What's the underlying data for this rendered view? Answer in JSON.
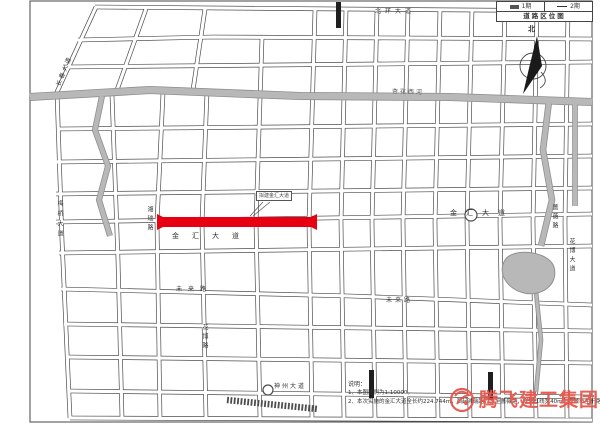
{
  "legend": {
    "title": "道路区位图",
    "items": [
      {
        "symbol": "bar",
        "label": "1期"
      },
      {
        "symbol": "line",
        "label": "2期"
      }
    ]
  },
  "north_label": "北",
  "callout": {
    "text": "拟建金汇大道"
  },
  "notes": {
    "heading": "说明：",
    "items": [
      "1、本图比例为1:10000。",
      "2、本次实施的金汇大道全长约224.744m，西起湘瑞路，东至蔷薇路，规划红线宽40m，为城市主干路。"
    ]
  },
  "logo": {
    "text": "腾飞建工集团"
  },
  "colors": {
    "red": "#e60012",
    "casing": "#4d4d4d",
    "road_fill": "#ffffff",
    "river": "#b8b8b8",
    "river_edge": "#8f8f8f",
    "ink": "#333333",
    "logo_red": "#e4574d",
    "black_seg": "#1f1f1f",
    "border": "#444444"
  },
  "map": {
    "border": {
      "x": 30,
      "y": 1,
      "w": 562,
      "h": 421
    },
    "streets": [
      [
        [
          95,
          7
        ],
        [
          592,
          11
        ]
      ],
      [
        [
          96,
          7
        ],
        [
          57,
          92
        ],
        [
          62,
          240
        ],
        [
          70,
          418
        ]
      ],
      [
        [
          146,
          9
        ],
        [
          117,
          90
        ]
      ],
      [
        [
          205,
          9
        ],
        [
          193,
          90
        ]
      ],
      [
        [
          78,
          40
        ],
        [
          213,
          37
        ],
        [
          592,
          39
        ]
      ],
      [
        [
          63,
          67
        ],
        [
          592,
          62
        ]
      ],
      [
        [
          58,
          129
        ],
        [
          592,
          124
        ]
      ],
      [
        [
          57,
          162
        ],
        [
          592,
          156
        ]
      ],
      [
        [
          56,
          194
        ],
        [
          592,
          188
        ]
      ],
      [
        [
          56,
          222
        ],
        [
          592,
          214
        ]
      ],
      [
        [
          59,
          253
        ],
        [
          592,
          246
        ]
      ],
      [
        [
          61,
          289
        ],
        [
          350,
          296
        ],
        [
          592,
          305
        ]
      ],
      [
        [
          64,
          324
        ],
        [
          592,
          331
        ]
      ],
      [
        [
          66,
          357
        ],
        [
          592,
          363
        ]
      ],
      [
        [
          68,
          391
        ],
        [
          592,
          397
        ]
      ],
      [
        [
          70,
          418
        ],
        [
          592,
          420
        ]
      ],
      [
        [
          112,
          95
        ],
        [
          118,
          260
        ],
        [
          122,
          418
        ]
      ],
      [
        [
          163,
          93
        ],
        [
          157,
          222
        ],
        [
          160,
          418
        ]
      ],
      [
        [
          207,
          92
        ],
        [
          202,
          222
        ],
        [
          206,
          418
        ]
      ],
      [
        [
          262,
          38
        ],
        [
          256,
          222
        ],
        [
          260,
          418
        ]
      ],
      [
        [
          315,
          10
        ],
        [
          309,
          222
        ],
        [
          312,
          418
        ]
      ],
      [
        [
          346,
          10
        ],
        [
          341,
          222
        ],
        [
          344,
          418
        ]
      ],
      [
        [
          377,
          9
        ],
        [
          372,
          222
        ],
        [
          375,
          418
        ]
      ],
      [
        [
          408,
          9
        ],
        [
          403,
          222
        ],
        [
          406,
          418
        ]
      ],
      [
        [
          440,
          9
        ],
        [
          435,
          222
        ],
        [
          438,
          418
        ]
      ],
      [
        [
          472,
          9
        ],
        [
          467,
          222
        ],
        [
          470,
          418
        ]
      ],
      [
        [
          505,
          9
        ],
        [
          500,
          222
        ],
        [
          503,
          418
        ]
      ],
      [
        [
          537,
          9
        ],
        [
          533,
          222
        ],
        [
          536,
          418
        ]
      ],
      [
        [
          568,
          9
        ],
        [
          565,
          222
        ],
        [
          567,
          418
        ]
      ]
    ],
    "rivers": [
      {
        "pts": [
          [
            30,
            97
          ],
          [
            150,
            90
          ],
          [
            300,
            96
          ],
          [
            450,
            97
          ],
          [
            592,
            102
          ]
        ],
        "w": 6.5
      },
      {
        "pts": [
          [
            102,
            96
          ],
          [
            95,
            130
          ],
          [
            108,
            166
          ],
          [
            99,
            200
          ],
          [
            110,
            236
          ]
        ],
        "w": 4.5
      },
      {
        "pts": [
          [
            549,
            101
          ],
          [
            543,
            150
          ],
          [
            552,
            200
          ],
          [
            541,
            246
          ]
        ],
        "w": 5
      },
      {
        "pts": [
          [
            536,
            292
          ],
          [
            541,
            340
          ],
          [
            536,
            392
          ]
        ],
        "w": 3
      },
      {
        "pts": [
          [
            575,
            102
          ],
          [
            575,
            206
          ]
        ],
        "w": 4
      }
    ],
    "lake_path": "M505,260 C513,247 549,251 554,267 C559,285 541,297 524,293 C507,289 497,273 505,260 Z",
    "black_segments": [
      {
        "x": 336,
        "y": 2,
        "w": 5,
        "h": 26
      },
      {
        "x": 369,
        "y": 370,
        "w": 5,
        "h": 28
      },
      {
        "x": 488,
        "y": 372,
        "w": 5,
        "h": 28
      }
    ],
    "hatched_segment": {
      "pts": [
        [
          227,
          400
        ],
        [
          318,
          409
        ]
      ],
      "w": 6.5
    },
    "red_road": {
      "x": 163,
      "y": 217,
      "w": 148,
      "h": 10
    },
    "roundabouts": [
      {
        "cx": 471,
        "cy": 215,
        "r": 6
      },
      {
        "cx": 268,
        "cy": 390,
        "r": 5
      }
    ],
    "leaders": [
      [
        [
          263,
          202
        ],
        [
          250,
          216
        ]
      ],
      [
        [
          270,
          202
        ],
        [
          253,
          216
        ]
      ]
    ],
    "labels": [
      {
        "t": "长春大道",
        "x": 56,
        "y": 85,
        "fs": 6,
        "rot": -68,
        "ls": 2
      },
      {
        "t": "北环大道",
        "x": 375,
        "y": 9,
        "fs": 6,
        "ls": 4
      },
      {
        "t": "杏花西河",
        "x": 392,
        "y": 89,
        "fs": 6,
        "rot": 2,
        "ls": 2,
        "color": "#555555"
      },
      {
        "t": "湘瑞路",
        "x": 146,
        "y": 206,
        "fs": 6,
        "vert": true,
        "ls": 3
      },
      {
        "t": "金汇大道",
        "x": 172,
        "y": 233,
        "fs": 7,
        "ls": 13
      },
      {
        "t": "金汇大道",
        "x": 450,
        "y": 210,
        "fs": 7,
        "ls": 9
      },
      {
        "t": "蔷薇路",
        "x": 551,
        "y": 204,
        "fs": 6,
        "vert": true,
        "ls": 3
      },
      {
        "t": "梅桥大道",
        "x": 56,
        "y": 200,
        "fs": 6,
        "vert": true,
        "ls": 4
      },
      {
        "t": "花博大道",
        "x": 568,
        "y": 238,
        "fs": 6,
        "vert": true,
        "ls": 3
      },
      {
        "t": "未来路",
        "x": 176,
        "y": 287,
        "fs": 6,
        "ls": 6
      },
      {
        "t": "未来路",
        "x": 386,
        "y": 298,
        "fs": 6,
        "ls": 3
      },
      {
        "t": "花博路",
        "x": 201,
        "y": 324,
        "fs": 6,
        "vert": true,
        "ls": 3
      },
      {
        "t": "神州大道",
        "x": 274,
        "y": 384,
        "fs": 6,
        "ls": 2
      }
    ]
  }
}
